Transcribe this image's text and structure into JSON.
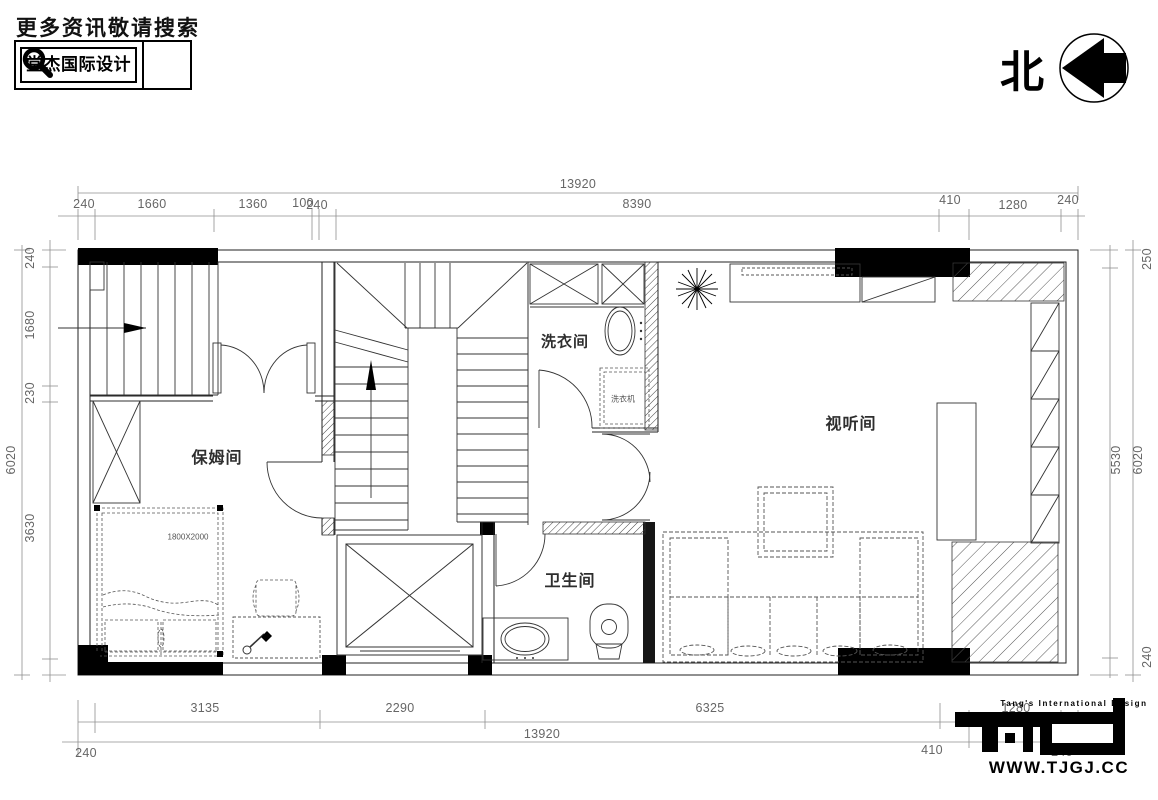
{
  "header": {
    "search_prompt": "更多资讯敬请搜索",
    "brand": "堂杰国际设计",
    "search_icon": "magnifier-icon"
  },
  "compass": {
    "north_label": "北",
    "icon": "north-arrow-icon"
  },
  "plan": {
    "rooms": [
      {
        "id": "laundry",
        "label": "洗衣间"
      },
      {
        "id": "nanny",
        "label": "保姆间"
      },
      {
        "id": "av",
        "label": "视听间"
      },
      {
        "id": "bath",
        "label": "卫生间"
      }
    ],
    "annotations": {
      "washer": "洗衣机",
      "bed_size": "1800X2000"
    },
    "symbols": [
      "plant-icon",
      "stairs",
      "elevator",
      "sofa",
      "coffee-table",
      "bed",
      "wardrobe",
      "toilet",
      "sink",
      "bathtub-basin",
      "washing-machine"
    ]
  },
  "dimensions": {
    "top": {
      "total": "13920",
      "segments": [
        "240",
        "1660",
        "1360",
        "100",
        "240",
        "8390",
        "410",
        "1280",
        "240"
      ]
    },
    "bottom": {
      "total": "13920",
      "segments": [
        "240",
        "3135",
        "2290",
        "6325",
        "410",
        "1280",
        "240"
      ]
    },
    "left": {
      "total": "6020",
      "segments": [
        "240",
        "1680",
        "230",
        "3630"
      ]
    },
    "right": {
      "total": "6020",
      "segments": [
        "250",
        "5530",
        "240"
      ]
    }
  },
  "footer": {
    "tagline": "Tang's International Design",
    "website": "WWW.TJGJ.CC",
    "logo_icon": "tjid-logo-icon"
  },
  "colors": {
    "line": "#222222",
    "dim": "#666666",
    "fill": "#000000",
    "paper": "#ffffff"
  }
}
